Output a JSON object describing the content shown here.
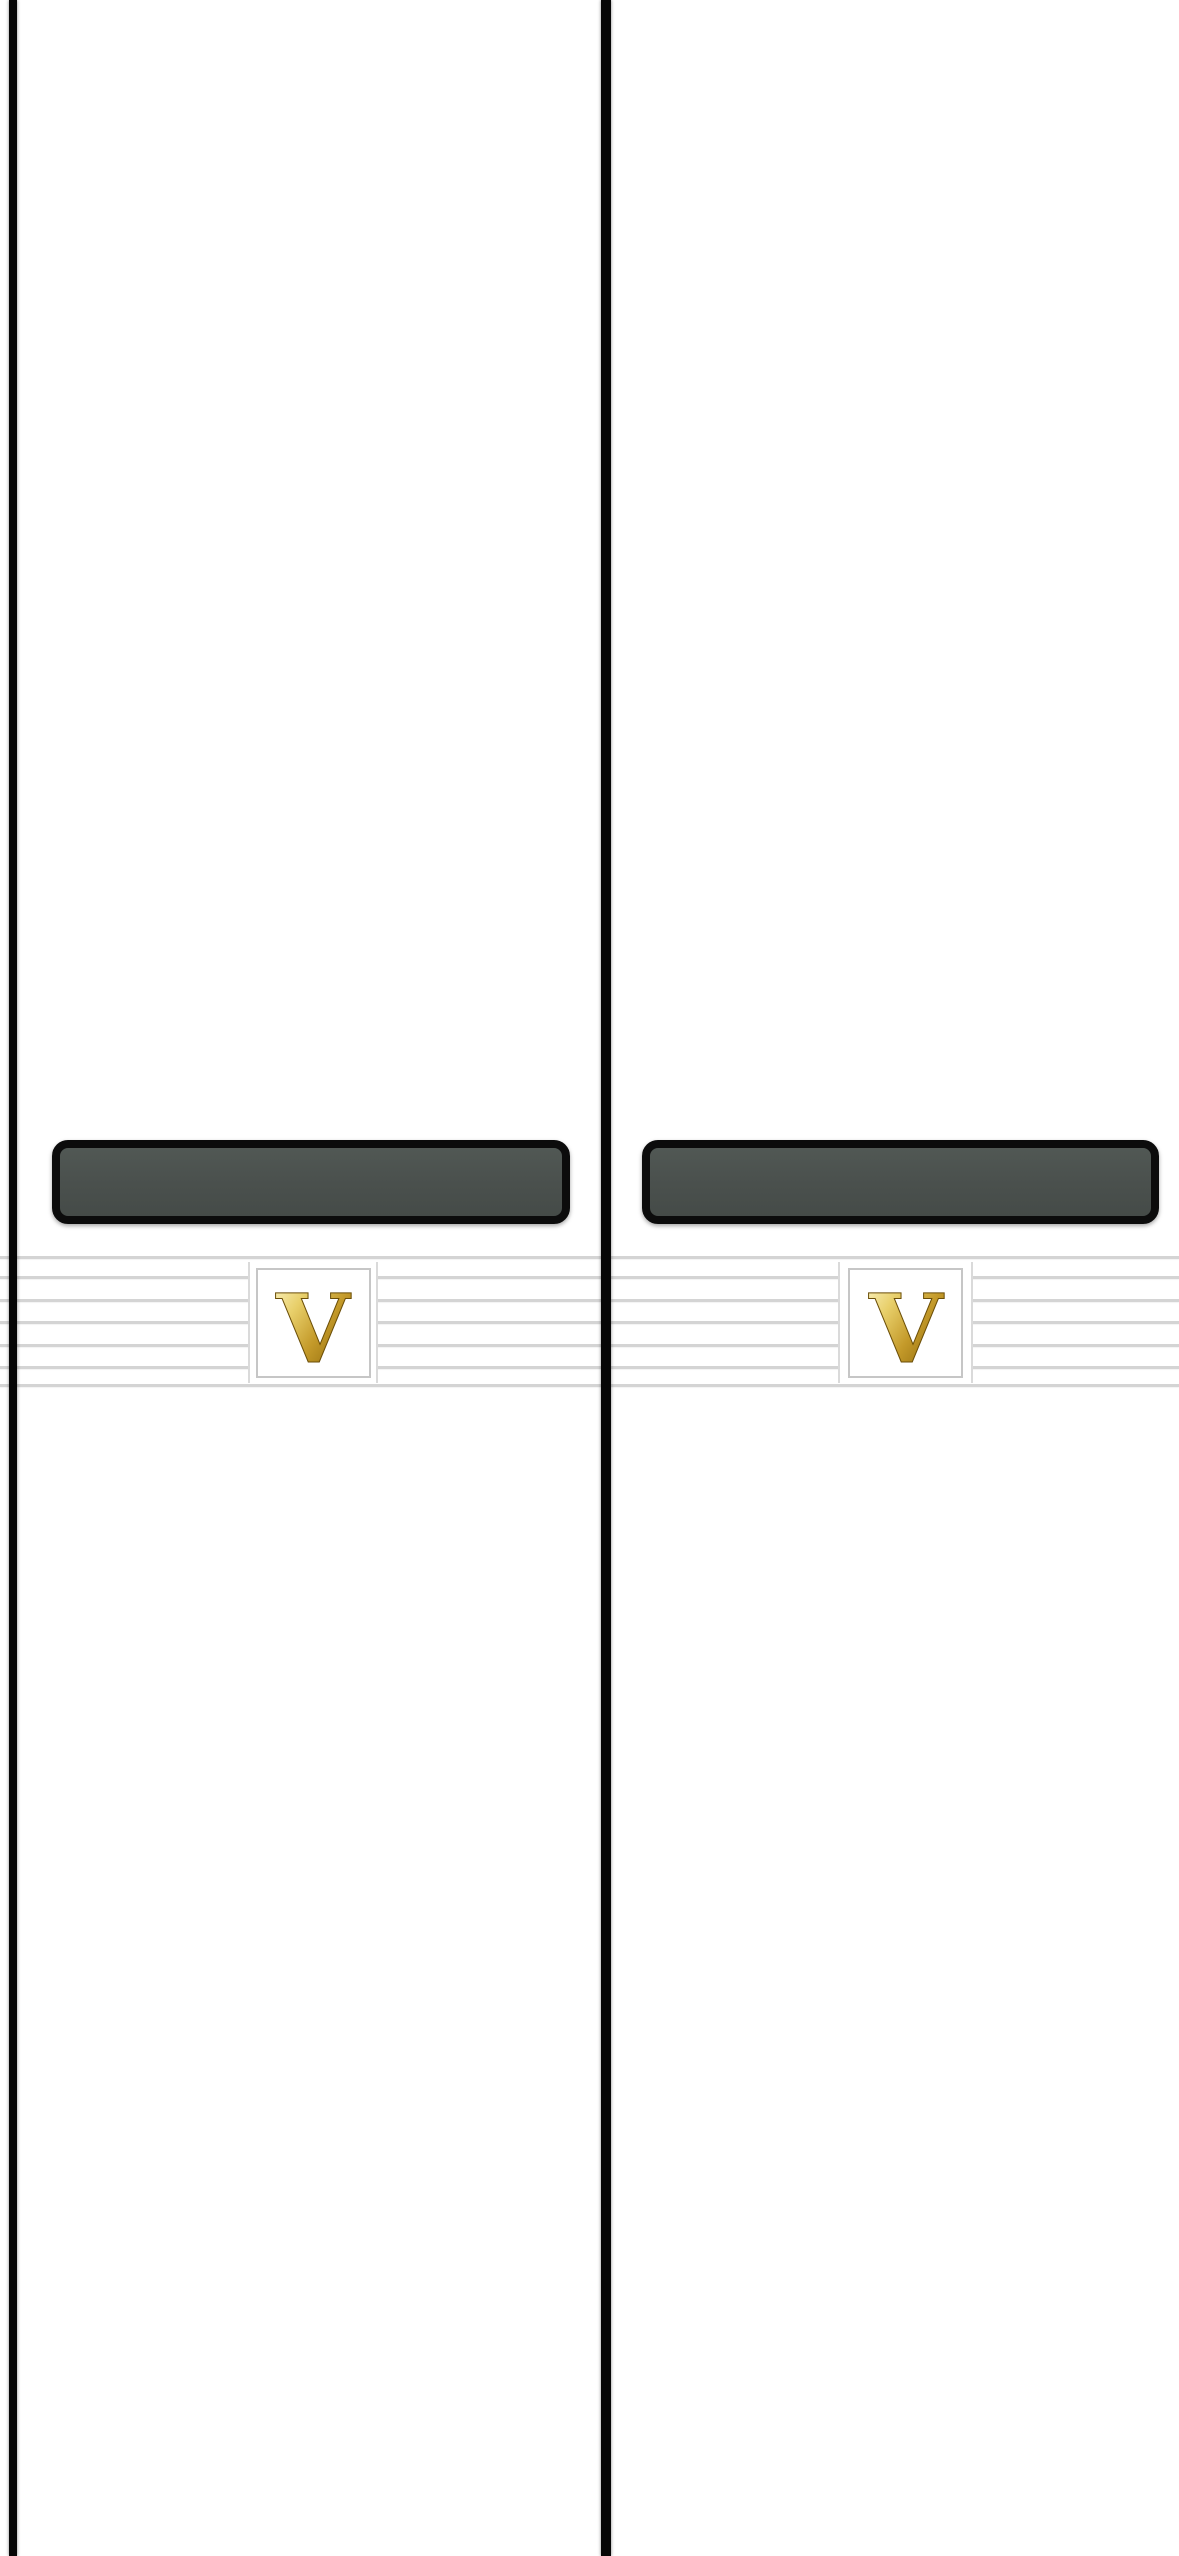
{
  "scene": {
    "type": "photograph",
    "description": "Close-up photo of two matching white book spines standing side by side. Each spine has a full-height black edge line, a dark slate label plate with a thick black rounded border, and a band of seven thin gray horizontal rules interrupted by a small white framed panel holding an embossed gold serif letter monogram.",
    "background_color": "#ffffff"
  },
  "colors": {
    "spine_outline": "#070707",
    "plate_fill": "#4b514e",
    "plate_border": "#0c0c0c",
    "rule_line": "#d4d4d4",
    "panel_frame": "#c6c6c6",
    "gold_highlight": "#fdf6c9",
    "gold_mid": "#d9b44a",
    "gold_deep": "#6f5208"
  },
  "spines": [
    {
      "position": "left",
      "monogram": "V"
    },
    {
      "position": "right",
      "monogram": "V"
    }
  ]
}
